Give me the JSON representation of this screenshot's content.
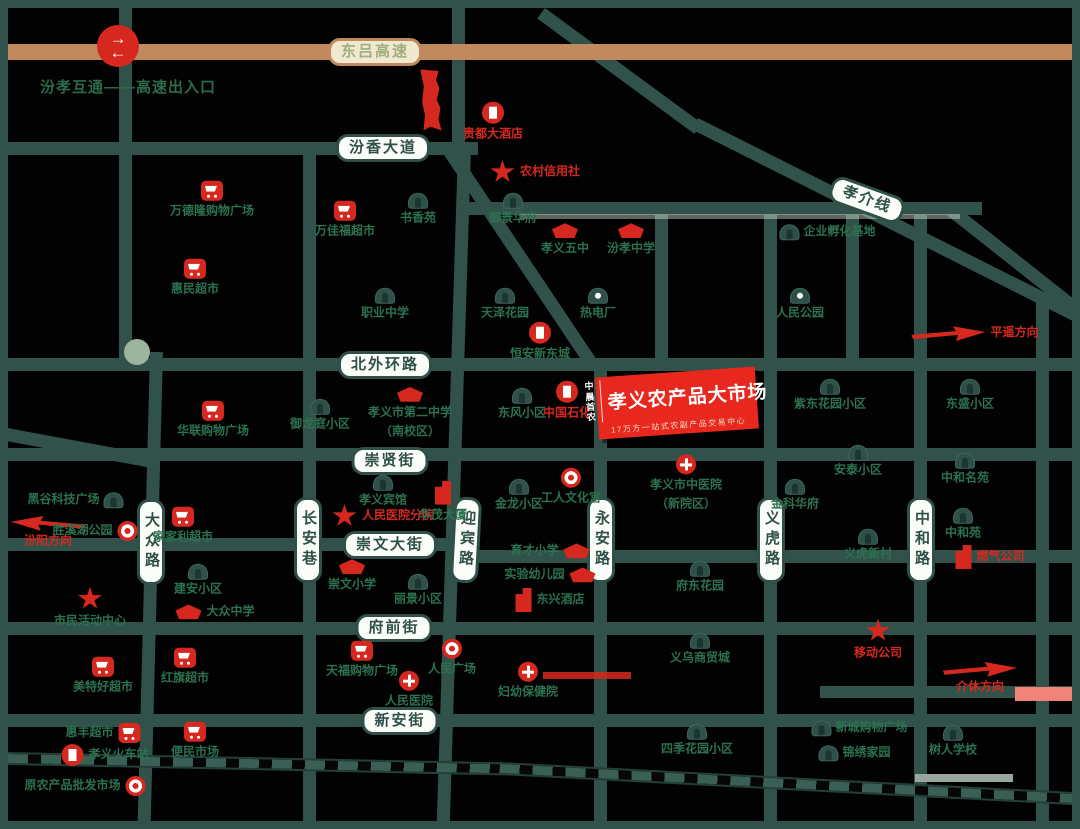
{
  "highway": {
    "label": "东吕高速"
  },
  "roads": {
    "fenxiang": "汾香大道",
    "xiaojie": "孝介线",
    "beiwaihuan": "北外环路",
    "chongxian": "崇贤街",
    "chongwen": "崇文大街",
    "fuqian": "府前街",
    "xinan": "新安街",
    "dazhong": "大众路",
    "changan": "长安巷",
    "yingbin": "迎宾路",
    "yongan": "永安路",
    "yihu": "义虎路",
    "zhonghe": "中和路"
  },
  "note": {
    "interchange": "汾孝互通——高速出入口"
  },
  "market": {
    "logo_top": "中晨",
    "logo_bottom": "首农",
    "title": "孝义农产品大市场",
    "subtitle": "17万方一站式农副产品交易中心"
  },
  "colors": {
    "road": "#30524A",
    "highway": "#C18A5E",
    "accent_red": "#D7281F",
    "poi_green": "#2C7150"
  },
  "pois": [
    {
      "label": "贵都大酒店"
    },
    {
      "label": "农村信用社"
    },
    {
      "label": "御景华府"
    },
    {
      "label": "孝义五中"
    },
    {
      "label": "汾孝中学"
    },
    {
      "label": "企业孵化基地"
    },
    {
      "label": "万德隆购物广场"
    },
    {
      "label": "万佳福超市"
    },
    {
      "label": "书香苑"
    },
    {
      "label": "惠民超市"
    },
    {
      "label": "职业中学"
    },
    {
      "label": "天泽花园"
    },
    {
      "label": "热电厂"
    },
    {
      "label": "人民公园"
    },
    {
      "label": "恒安新东城"
    },
    {
      "label": "平遥方向"
    },
    {
      "label": "华联购物广场"
    },
    {
      "label": "御龙庭小区"
    },
    {
      "label": "孝义市第二中学",
      "label2": "（南校区）"
    },
    {
      "label": "东风小区"
    },
    {
      "label": "中国石化"
    },
    {
      "label": "紫东花园小区"
    },
    {
      "label": "东盛小区"
    },
    {
      "label": "安泰小区"
    },
    {
      "label": "中和名苑"
    },
    {
      "label": "孝义宾馆"
    },
    {
      "label": "人民医院分院"
    },
    {
      "label": "华茂大厦"
    },
    {
      "label": "金龙小区"
    },
    {
      "label": "工人文化宫"
    },
    {
      "label": "孝义市中医院",
      "label2": "（新院区）"
    },
    {
      "label": "金科华府"
    },
    {
      "label": "黑谷科技广场"
    },
    {
      "label": "汾阳方向"
    },
    {
      "label": "胜溪湖公园"
    },
    {
      "label": "家家利超市"
    },
    {
      "label": "建安小区"
    },
    {
      "label": "市民活动中心"
    },
    {
      "label": "大众中学"
    },
    {
      "label": "崇文小学"
    },
    {
      "label": "丽景小区"
    },
    {
      "label": "育才小学"
    },
    {
      "label": "实验幼儿园"
    },
    {
      "label": "东兴酒店"
    },
    {
      "label": "府东花园"
    },
    {
      "label": "义虎新村"
    },
    {
      "label": "中和苑"
    },
    {
      "label": "燃气公司"
    },
    {
      "label": "天福购物广场"
    },
    {
      "label": "人民广场"
    },
    {
      "label": "人民医院"
    },
    {
      "label": "妇幼保健院"
    },
    {
      "label": "移动公司"
    },
    {
      "label": "义乌商贸城"
    },
    {
      "label": "美特好超市"
    },
    {
      "label": "红旗超市"
    },
    {
      "label": "介休方向"
    },
    {
      "label": "惠丰超市"
    },
    {
      "label": "孝义火车站"
    },
    {
      "label": "原农产品批发市场"
    },
    {
      "label": "便民市场"
    },
    {
      "label": "四季花园小区"
    },
    {
      "label": "新城购物广场"
    },
    {
      "label": "锦绣家园"
    },
    {
      "label": "树人学校"
    }
  ]
}
